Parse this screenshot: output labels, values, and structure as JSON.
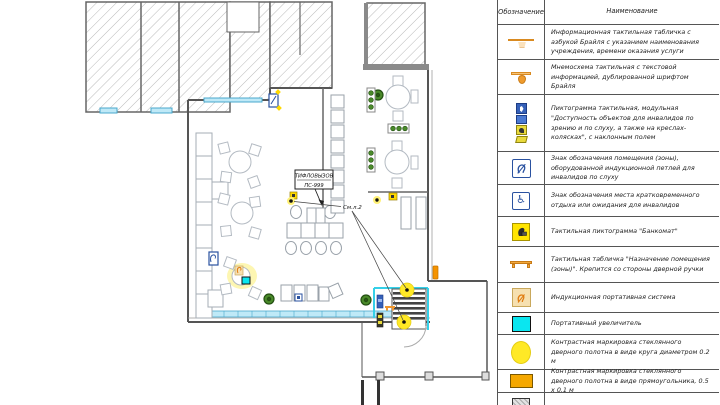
{
  "colors": {
    "wall": "#555555",
    "hatch_line": "#b9b9b9",
    "window_glass": "#bfe9f7",
    "window_frame": "#49a8cc",
    "glass_partition": "#35d0e8",
    "highlight_yellow": "#ffe926",
    "marker_orange": "#f0972e",
    "sign_blue": "#2a52a0",
    "plant_green": "#4a8a2a",
    "magnifier_cyan": "#0ae6f0"
  },
  "legend": {
    "header": {
      "symbol": "Обозначение",
      "name": "Наименование"
    },
    "rows": [
      {
        "icon": "wide-tactile-sign",
        "name": "Информационная тактильная табличка с азбукой Брайля с указанием наименования учреждения, времени оказания услуги"
      },
      {
        "icon": "tactile-mnemoscheme",
        "name": "Мнемосхема тактильная с текстовой информацией, дублированной шрифтом Брайля"
      },
      {
        "icon": "modular-pictogram",
        "name": "Пиктограмма тактильная, модульная \"Доступность объектов для инвалидов по зрению и по слуху, а также на креслах-колясках\", с наклонным полем"
      },
      {
        "icon": "induction-loop-sign",
        "name": "Знак обозначения помещения (зоны), оборудованной индукционной петлей для инвалидов по слуху"
      },
      {
        "icon": "wheelchair-rest-sign",
        "name": "Знак обозначения места кратковременного отдыха или ожидания для инвалидов"
      },
      {
        "icon": "bankomat-pictogram",
        "name": "Тактильная пиктограмма \"Банкомат\""
      },
      {
        "icon": "door-tactile-sign",
        "name": "Тактильная табличка \"Назначение помещения (зоны)\". Крепится со стороны дверной ручки"
      },
      {
        "icon": "portable-induction-system",
        "name": "Индукционная портативная система"
      },
      {
        "icon": "portable-magnifier",
        "name": "Портативный увеличитель"
      },
      {
        "icon": "contrast-circle-marking",
        "name": "Контрастная маркировка стеклянного дверного полотна в виде круга диаметром 0.2 м"
      },
      {
        "icon": "contrast-rect-marking",
        "name": "Контрастная маркировка стеклянного дверного полотна в виде прямоугольника, 0.5 x 0.1 м"
      },
      {
        "icon": "hatched-area",
        "name": ""
      }
    ]
  },
  "plan": {
    "labels": {
      "tiflo_line1": "ТИФЛОВЫЗОВ",
      "tiflo_line2": "ПС-999",
      "see_sheet": "См.л.2"
    }
  }
}
